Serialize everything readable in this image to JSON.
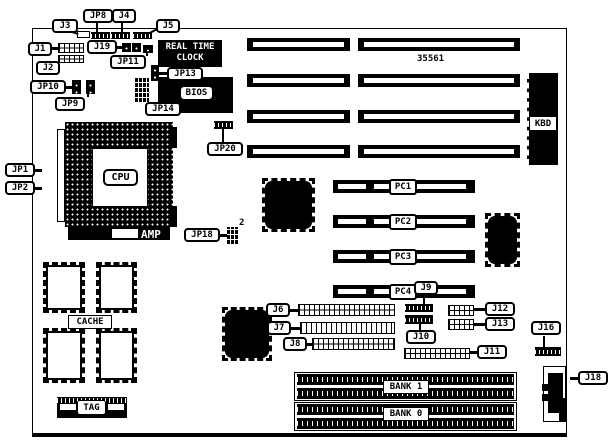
{
  "board": {
    "part_number": "35561",
    "labels": {
      "j3": "J3",
      "jp8": "JP8",
      "j4": "J4",
      "j5": "J5",
      "j1": "J1",
      "j19": "J19",
      "jp11": "JP11",
      "j2": "J2",
      "jp10": "JP10",
      "jp9": "JP9",
      "jp13": "JP13",
      "jp14": "JP14",
      "jp20": "JP20",
      "jp1": "JP1",
      "jp2": "JP2",
      "jp18": "JP18",
      "jp18_pin": "2",
      "j6": "J6",
      "j7": "J7",
      "j8": "J8",
      "j9": "J9",
      "j10": "J10",
      "j11": "J11",
      "j12": "J12",
      "j13": "J13",
      "j16": "J16",
      "j18": "J18"
    },
    "components": {
      "rtc_line1": "REAL TIME",
      "rtc_line2": "CLOCK",
      "bios": "BIOS",
      "kbd": "KBD",
      "cpu": "CPU",
      "amp": "AMP",
      "cache": "CACHE",
      "tag": "TAG",
      "bank1": "BANK 1",
      "bank0": "BANK 0"
    },
    "slots": {
      "pc1": "PC1",
      "pc2": "PC2",
      "pc3": "PC3",
      "pc4": "PC4"
    },
    "colors": {
      "ink": "#000000",
      "paper": "#ffffff"
    }
  }
}
